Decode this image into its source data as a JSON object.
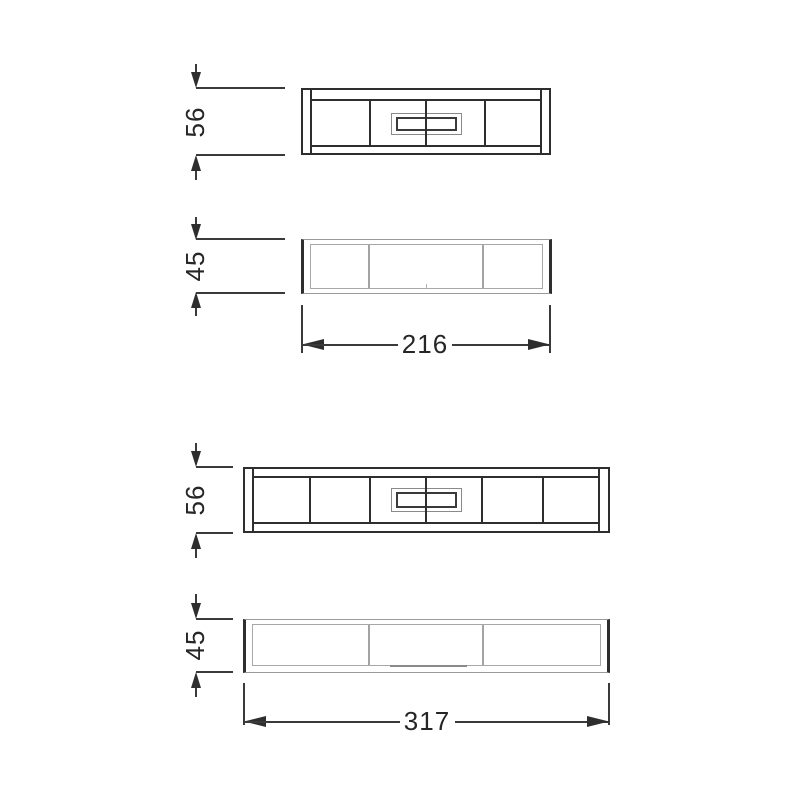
{
  "dimensions": {
    "small_unit": {
      "height": "56",
      "depth": "45",
      "width": "216"
    },
    "large_unit": {
      "height": "56",
      "depth": "45",
      "width": "317"
    }
  },
  "colors": {
    "object_line": "#2e2e2e",
    "light_line": "#a3a3a3",
    "dimension_line": "#3a3a3a",
    "text": "#262626",
    "background": "#ffffff"
  }
}
